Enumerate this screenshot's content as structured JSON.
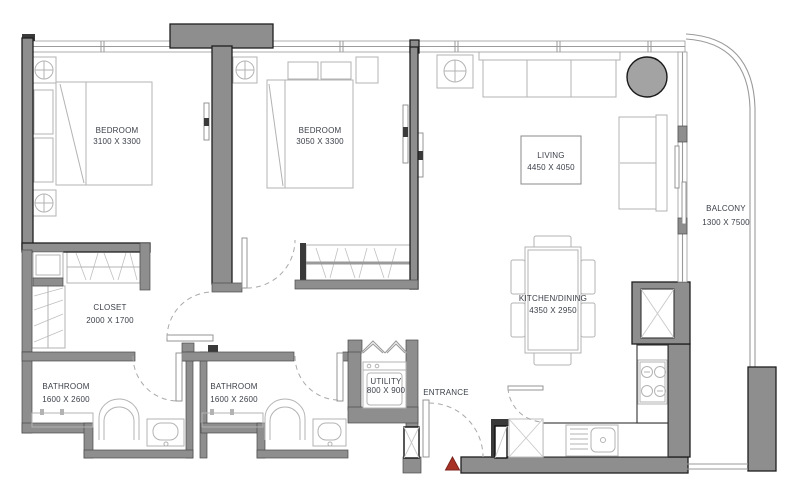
{
  "plan": {
    "type": "apartment-floor-plan",
    "rooms": {
      "bedroom_1": {
        "name": "BEDROOM",
        "dims": "3100 X 3300"
      },
      "bedroom_2": {
        "name": "BEDROOM",
        "dims": "3050 X 3300"
      },
      "living": {
        "name": "LIVING",
        "dims": "4450 X 4050"
      },
      "kitchen_dining": {
        "name": "KITCHEN/DINING",
        "dims": "4350 X 2950"
      },
      "balcony": {
        "name": "BALCONY",
        "dims": "1300 X 7500"
      },
      "closet": {
        "name": "CLOSET",
        "dims": "2000 X 1700"
      },
      "bathroom_1": {
        "name": "BATHROOM",
        "dims": "1600 X 2600"
      },
      "bathroom_2": {
        "name": "BATHROOM",
        "dims": "1600 X 2600"
      },
      "utility": {
        "name": "UTILITY",
        "dims": "800 X 900"
      },
      "entrance": {
        "name": "ENTRANCE"
      }
    },
    "colors": {
      "wall": "#8e8e8e",
      "wall_outline": "#1f1f1f",
      "furniture_line": "#b3b3b3",
      "counter_outline": "#333333",
      "label_text": "#3b4049",
      "entrance_marker": "#a93226",
      "column_fill": "#a3a3a3",
      "glass": "#9a9a9a",
      "background": "#ffffff"
    },
    "icons": [
      "bed-icon",
      "pillow-icon",
      "nightstand-lamp-icon",
      "tv-icon",
      "wardrobe-icon",
      "sofa-icon",
      "armchair-icon",
      "side-table-lamp-icon",
      "round-column-icon",
      "dining-table-icon",
      "chair-icon",
      "stove-icon",
      "kitchen-sink-icon",
      "duct-shaft-icon",
      "washing-machine-icon",
      "bifold-door-icon",
      "toilet-icon",
      "washbasin-icon",
      "vanity-icon",
      "door-swing-icon",
      "pivot-column-icon",
      "shoe-cabinet-icon",
      "window-icon",
      "balcony-glass-icon",
      "entrance-marker-icon"
    ]
  }
}
